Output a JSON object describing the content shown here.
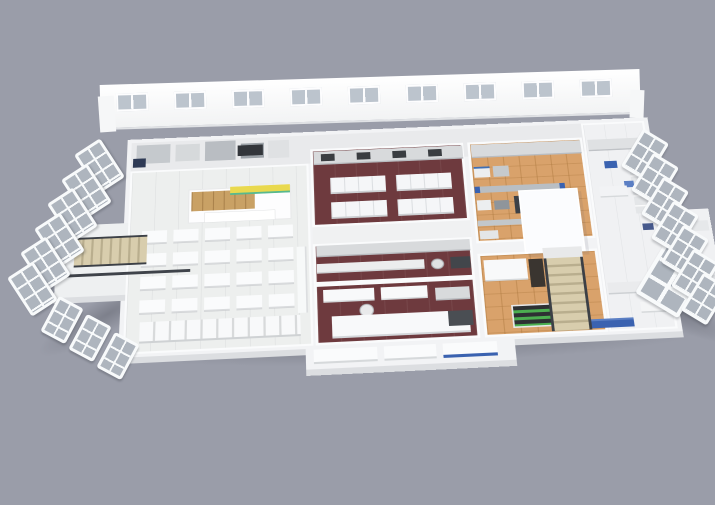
{
  "scene": {
    "subject": "3D cutaway floor-plan render of a food facility: dining hall with shop kiosk, maroon-floor training kitchens, wood-floor processing hall with machinery, white laboratory wing, perimeter window walls and two staircases",
    "background_color": "#9a9da9"
  },
  "palette": {
    "slab_white": "#f2f3f5",
    "wall_white": "#fafbfc",
    "dining_floor": "#edefee",
    "kitchen_floor_maroon": "#6e3a3e",
    "production_floor_wood": "#d9a26b",
    "lab_floor": "#f0f1f3",
    "glass_gray": "#b7bfc8",
    "equipment_steel": "#d8dadc",
    "equipment_dark": "#3c4046",
    "accent_blue": "#3a62b0",
    "accent_blue_light": "#5b7fc4",
    "kiosk_yellow": "#e9d94e",
    "kiosk_green": "#58b98e",
    "kiosk_wood": "#c9a165",
    "plant_green": "#4caf50",
    "stair_tread": "#d8cdad",
    "ground_shadow": "rgba(58,60,70,0.30)"
  },
  "windows": {
    "back": {
      "count": 9
    },
    "left": {
      "count": 6
    },
    "right": {
      "count": 7
    },
    "front_left": {
      "count": 3
    }
  },
  "dining_tables": {
    "rows": 4,
    "cols": 5
  }
}
